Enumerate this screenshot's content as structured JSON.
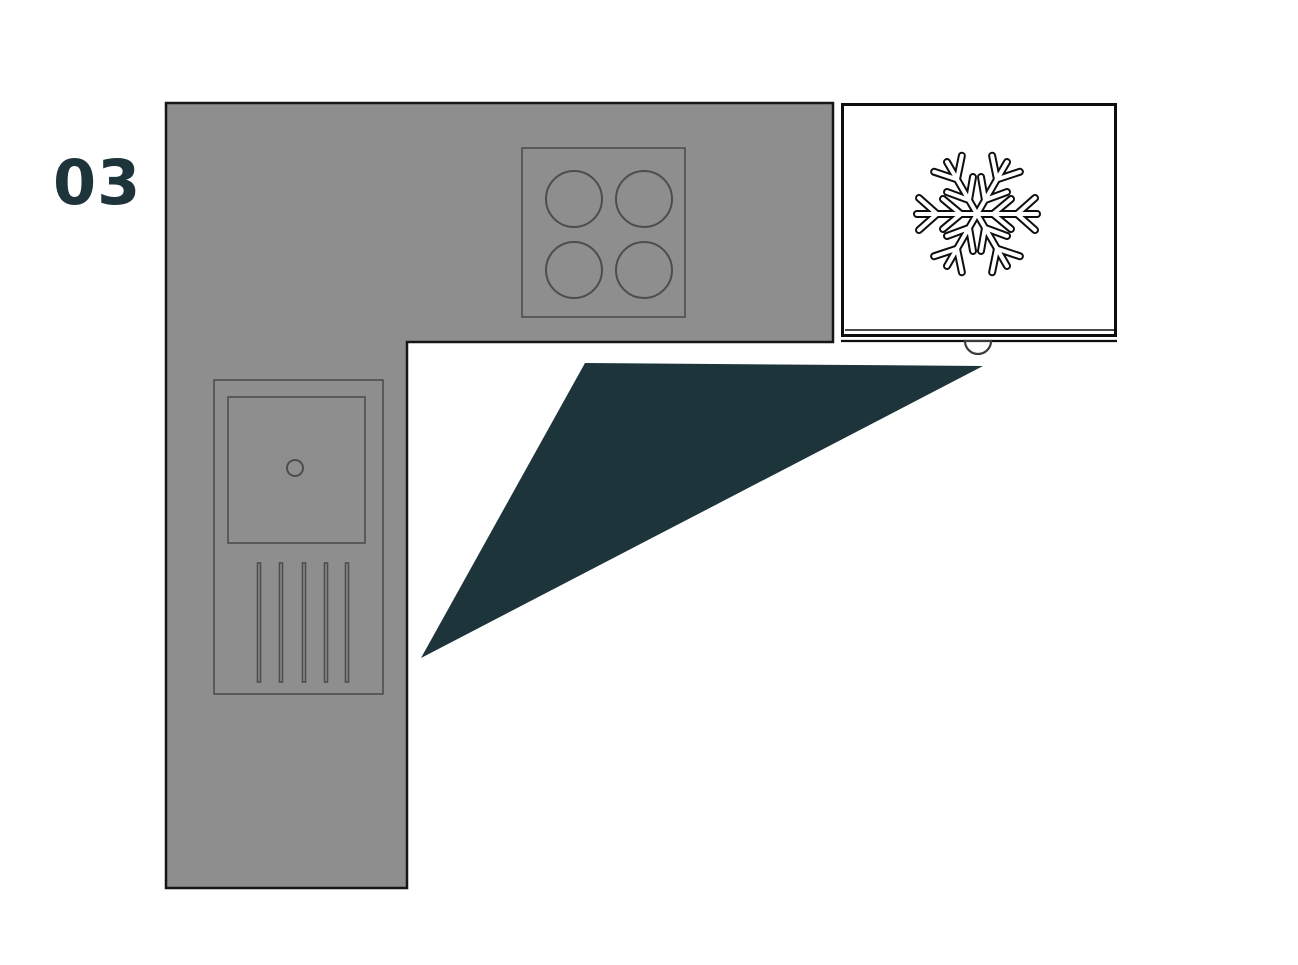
{
  "plan": {
    "number": "03"
  },
  "colors": {
    "background": "#ffffff",
    "accent": "#1d343b",
    "counter_fill": "#8e8e8e",
    "counter_outline": "#161616",
    "fixture_outline": "#4d4d4d",
    "appliance_outline": "#0e0e0e",
    "appliance_fill": "#ffffff"
  },
  "icons": {
    "freezer": "snowflake-icon"
  }
}
